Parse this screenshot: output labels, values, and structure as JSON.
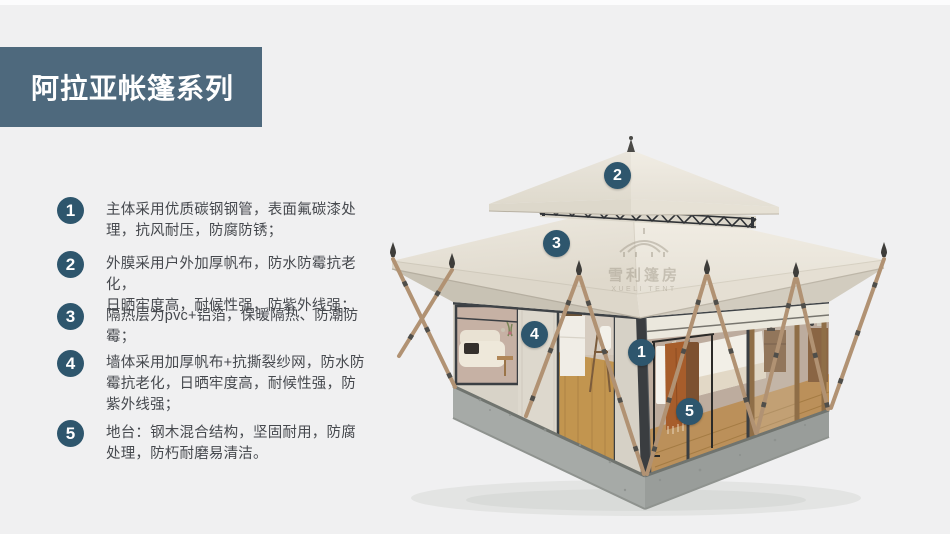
{
  "page": {
    "title": "阿拉亚帐篷系列"
  },
  "features": [
    {
      "num": "1",
      "text": "主体采用优质碳钢钢管，表面氟碳漆处\n理，抗风耐压，防腐防锈；"
    },
    {
      "num": "2",
      "text": "外膜采用户外加厚帆布，防水防霉抗老化，\n日晒牢度高，耐候性强，防紫外线强；"
    },
    {
      "num": "3",
      "text": "隔热层为pvc+铝箔，保暖隔热、防潮防\n霉；"
    },
    {
      "num": "4",
      "text": "墙体采用加厚帆布+抗撕裂纱网，防水防\n霉抗老化，日晒牢度高，耐候性强，防\n紫外线强；"
    },
    {
      "num": "5",
      "text": "地台：钢木混合结构，坚固耐用，防腐\n处理，防朽耐磨易清洁。"
    }
  ],
  "callouts": [
    {
      "num": "1"
    },
    {
      "num": "2"
    },
    {
      "num": "3"
    },
    {
      "num": "4"
    },
    {
      "num": "5"
    }
  ],
  "watermark": {
    "cn": "雪利篷房",
    "en": "XUELI TENT"
  },
  "colors": {
    "header_bg": "#4e697d",
    "badge": "#2e566d",
    "background": "#f0f0f1"
  }
}
